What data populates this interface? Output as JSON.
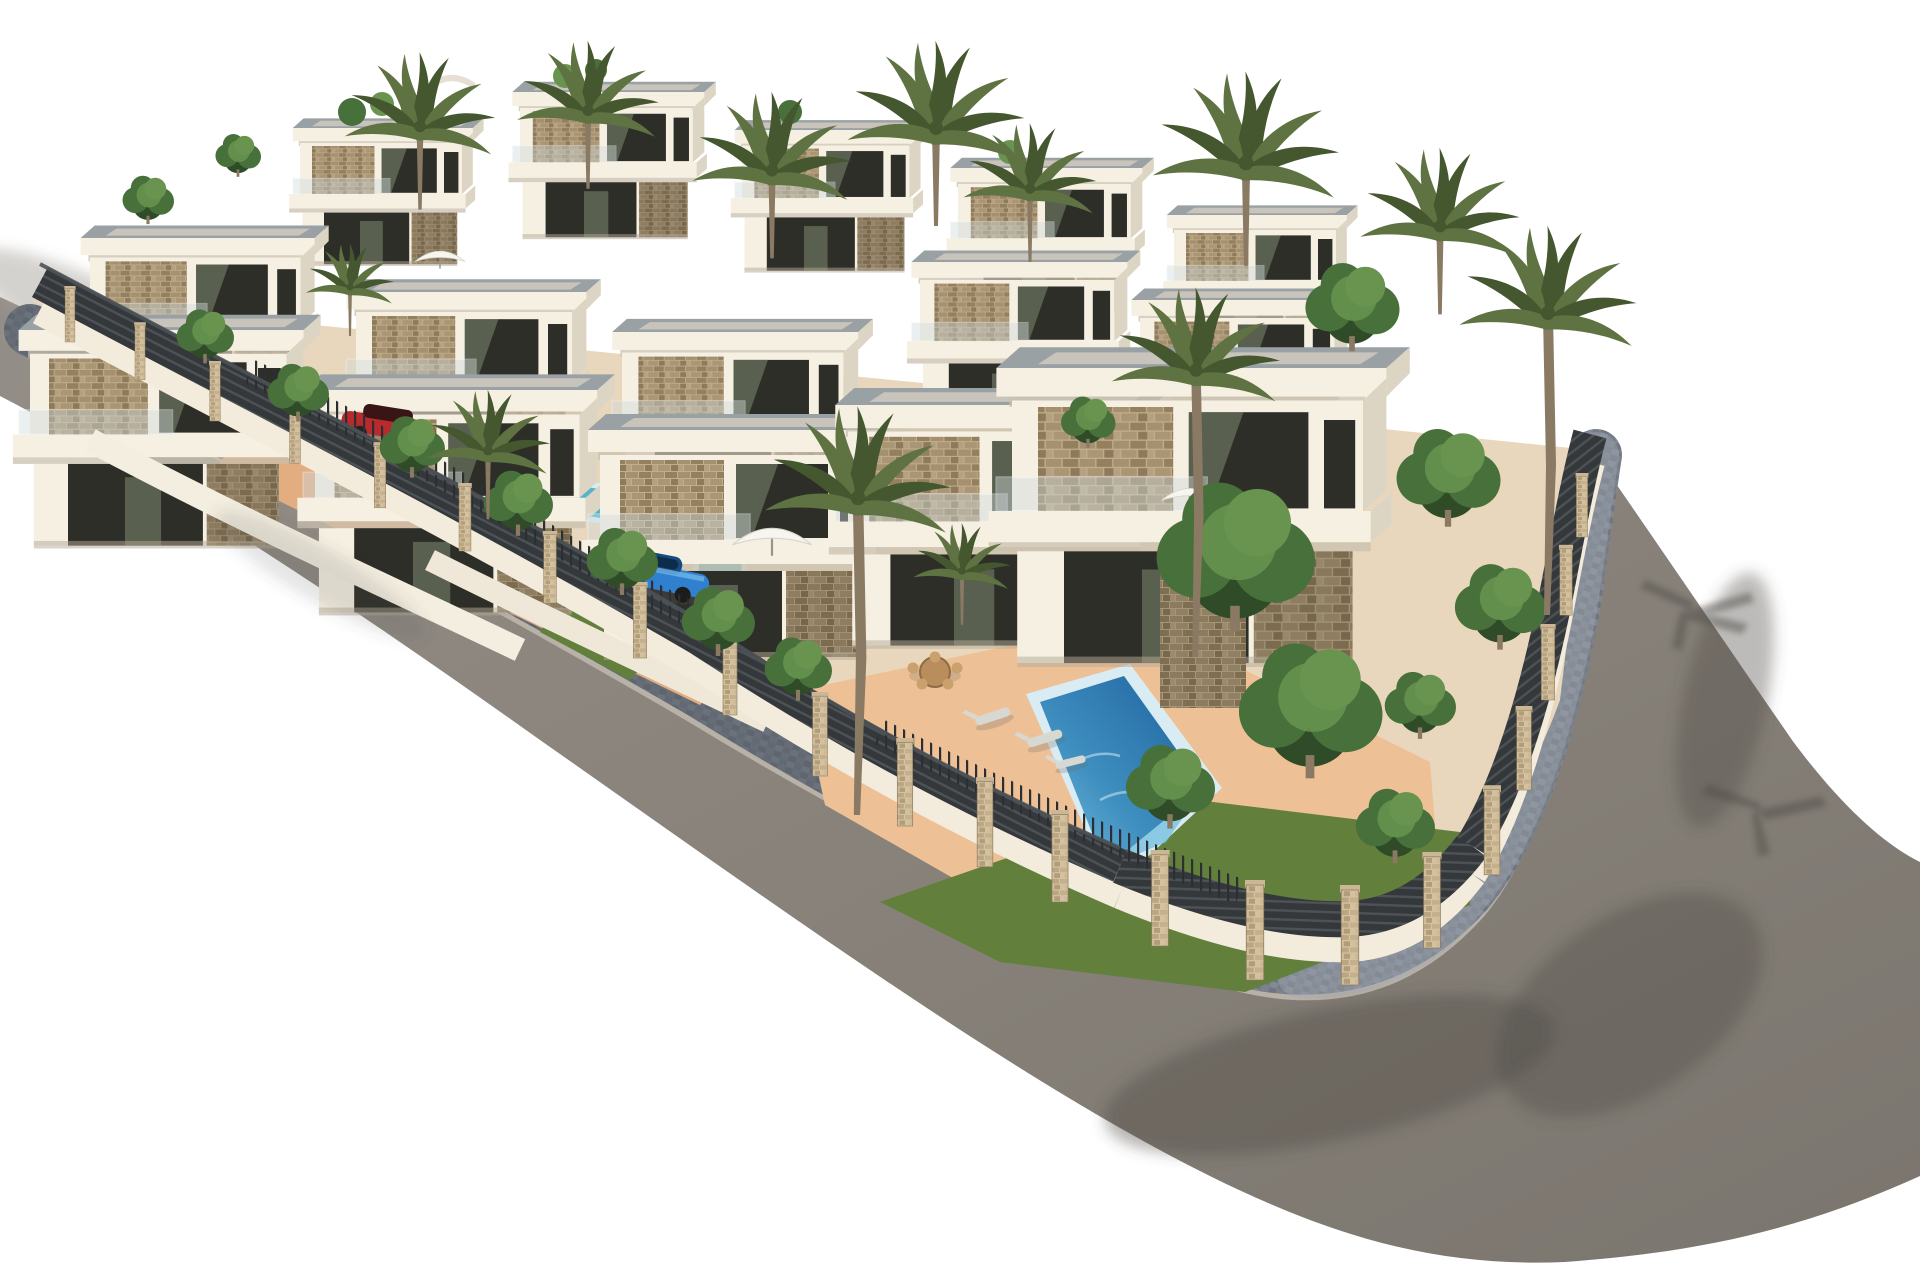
{
  "scene": {
    "type": "3d-architectural-render",
    "subject": "Aerial render of a modern white villa development with pools, palm trees and a curved perimeter road",
    "view": "elevated three-quarter exterior view on plain white background",
    "setting": "Mediterranean new-build residential estate on a terraced slope"
  },
  "colors": {
    "background": "#ffffff",
    "road": "#8d8781",
    "road-dark": "#746f69",
    "road-shadow": "#4f4b47",
    "curb": "#b7b1a8",
    "cobble": "#79808a",
    "cobble-shadow": "#454b54",
    "cobble-light": "#a2aab4",
    "fence-wall": "#f3ecdc",
    "fence-slat": "#34383b",
    "fence-slat-hi": "#4d5256",
    "stone-pillar": "#cdb996",
    "villa-white": "#f6f0e2",
    "villa-shade": "#ddd5c3",
    "villa-under": "#c9c0ad",
    "roof-top": "#9aa1a5",
    "roof-gravel": "#c8c3bb",
    "masonry": "#a4906f",
    "glass": "#2e2e29",
    "glass-green": "#7f8b70",
    "terrace": "#e2ad81",
    "terrace-light": "#eec096",
    "lawn": "#627f3c",
    "lawn-light": "#7c9b4e",
    "tree-dark": "#2f4b28",
    "tree-mid": "#47703a",
    "tree-light": "#699450",
    "palm-frond": "#5f7342",
    "palm-dark": "#44572f",
    "palm-trunk": "#8a7a64",
    "pool-rim": "#d9ecf3",
    "pool-deep": "#1d5f9c",
    "pool-light": "#7cc4e0",
    "pool-teal": "#57b4c6",
    "car-red": "#b92a2c",
    "car-blue": "#2f80cf",
    "wood": "#b98d5c",
    "lounger": "#d8d8d3",
    "parasol": "#f7f5ef"
  },
  "inventory": {
    "villas": {
      "count": 14,
      "floors": 2,
      "style": "flat-roof white cubic villas with beige stone cladding, cantilevered slabs and glass balustrades"
    },
    "swimming_pools": [
      {
        "name": "main-pool",
        "water": "deep blue",
        "location": "front garden near rounded fence corner"
      },
      {
        "name": "left-garden-pool",
        "water": "teal",
        "location": "middle-left garden"
      },
      {
        "name": "small-garden-pool",
        "water": "teal",
        "location": "behind left fence"
      }
    ],
    "cars": [
      {
        "name": "red-car",
        "color": "red",
        "location": "upper-left driveway behind railing fence"
      },
      {
        "name": "blue-car",
        "color": "blue",
        "location": "center-left driveway"
      }
    ],
    "palm_trees": 13,
    "green_trees": 18,
    "fence": {
      "style": "white rendered base wall with dark horizontal slats and travertine stone pillars",
      "pillar_count": 22
    },
    "roads": {
      "surface": "grey asphalt",
      "sidewalk": "dark cobblestone paving strip",
      "shape": "curves around the lower and right edge of the plot"
    },
    "furniture": [
      "round dining table with chairs",
      "sun loungers",
      "white parasols",
      "wicker lounge set"
    ]
  }
}
